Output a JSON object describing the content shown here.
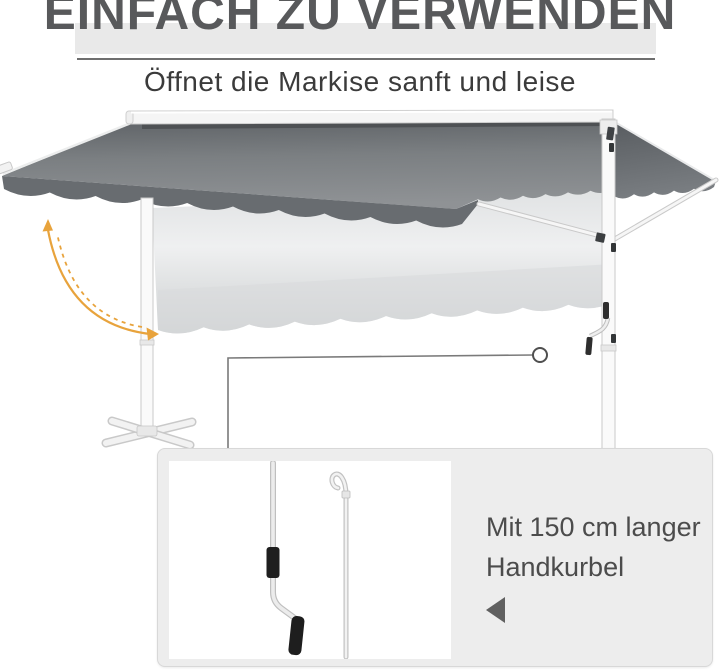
{
  "header": {
    "title": "EINFACH ZU VERWENDEN",
    "subtitle": "Öffnet die Markise sanft und leise"
  },
  "panel": {
    "line1": "Mit 150 cm langer",
    "line2": "Handkurbel"
  },
  "annotations": {
    "rotation_arrow": "curved double arrow indicating awning tilt motion",
    "callout": "circle marker on hand crank connected by line to detail inset"
  },
  "icons": [
    "rotation-arrow-icon",
    "callout-circle",
    "prev-triangle-icon",
    "crank-handle-illustration",
    "hook-rod-illustration"
  ],
  "colors": {
    "accent_orange": "#E8A33C",
    "canopy_dark": "#6E7275",
    "canopy_valance": "#686C70",
    "ghost_light": "#DDE0E1",
    "panel_bg": "#EDEDED",
    "title_gray": "#58595B",
    "text_gray": "#4C4C4C",
    "frame_white": "#FAFAFA"
  }
}
